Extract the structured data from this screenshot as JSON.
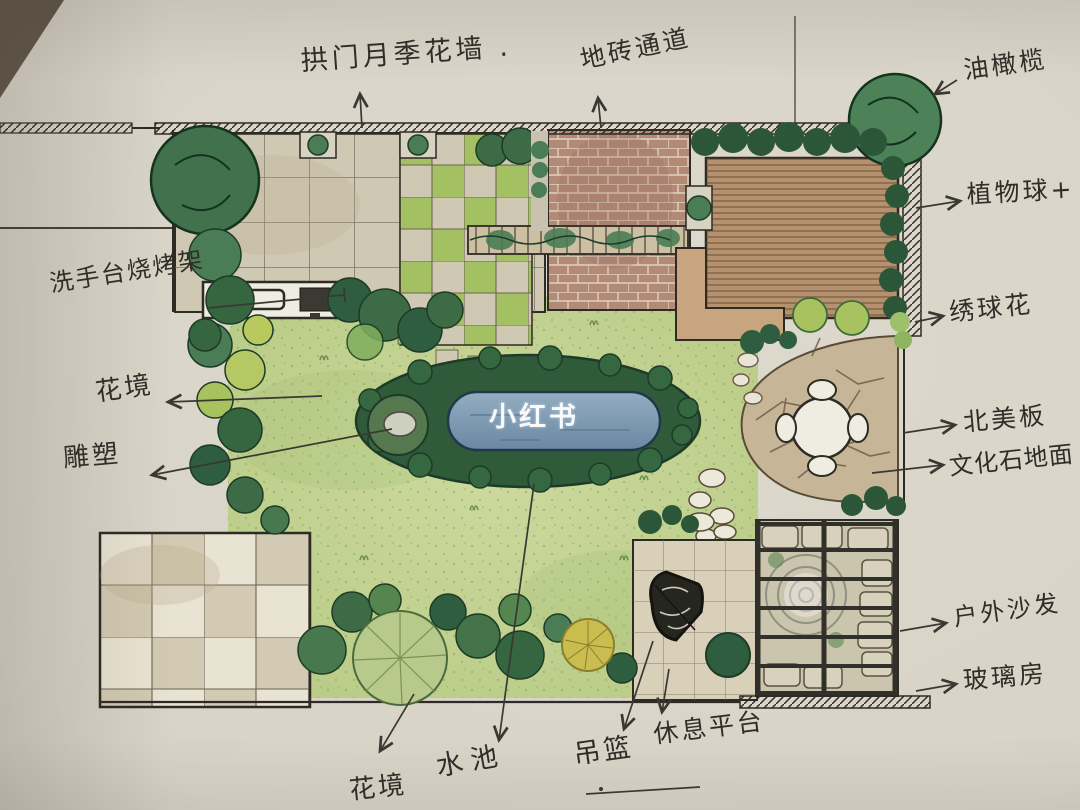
{
  "watermark": {
    "text": "小红书"
  },
  "annotations": {
    "arch_rose_wall": {
      "label": "拱门月季花墙 ."
    },
    "tile_path": {
      "label": "地砖通道"
    },
    "olive_tree": {
      "label": "油橄榄"
    },
    "plant_ball": {
      "label": "植物球+"
    },
    "hydrangea": {
      "label": "绣球花"
    },
    "wood_board": {
      "label": "北美板"
    },
    "culture_stone": {
      "label": "文化石地面"
    },
    "outdoor_sofa": {
      "label": "户外沙发"
    },
    "glass_house": {
      "label": "玻璃房"
    },
    "sink_bbq": {
      "label": "洗手台烧烤架"
    },
    "flower_border_left": {
      "label": "花境"
    },
    "sculpture": {
      "label": "雕塑"
    },
    "flower_border_bottom": {
      "label": "花境"
    },
    "pond": {
      "label": "水池"
    },
    "hanging_chair": {
      "label": "吊篮"
    },
    "rest_platform": {
      "label": "休息平台"
    }
  },
  "colors": {
    "paper": "#d9d4c9",
    "ink": "#33312b",
    "hand": "#2f2d28",
    "lawn1": "#cdd99e",
    "lawn2": "#b6ca83",
    "stipple": "#86a55c",
    "tile": "#cfc8b2",
    "tileLine": "#6e6554",
    "checkerGreen": "#a3c162",
    "brick": "#b28a76",
    "mortar": "#e0d2c2",
    "deck": "#b5916e",
    "deckLine": "#5f4632",
    "hedge": "#2c5638",
    "shrub": "#3c6b45",
    "shrubLight": "#4a7d55",
    "shrubYellow": "#b5c864",
    "pondRing": "#2f5b3a",
    "water1": "#93adc2",
    "water2": "#6a88a2",
    "flagstone": "#c6b596",
    "flagJoint": "#6b5644",
    "bench": "#c9a57f",
    "patioA": "#e9e3d3",
    "patioB": "#d2cab2",
    "platform": "#d9d0ba",
    "frame": "#32302a",
    "white": "#efece2",
    "watermark": "#ffffff"
  }
}
